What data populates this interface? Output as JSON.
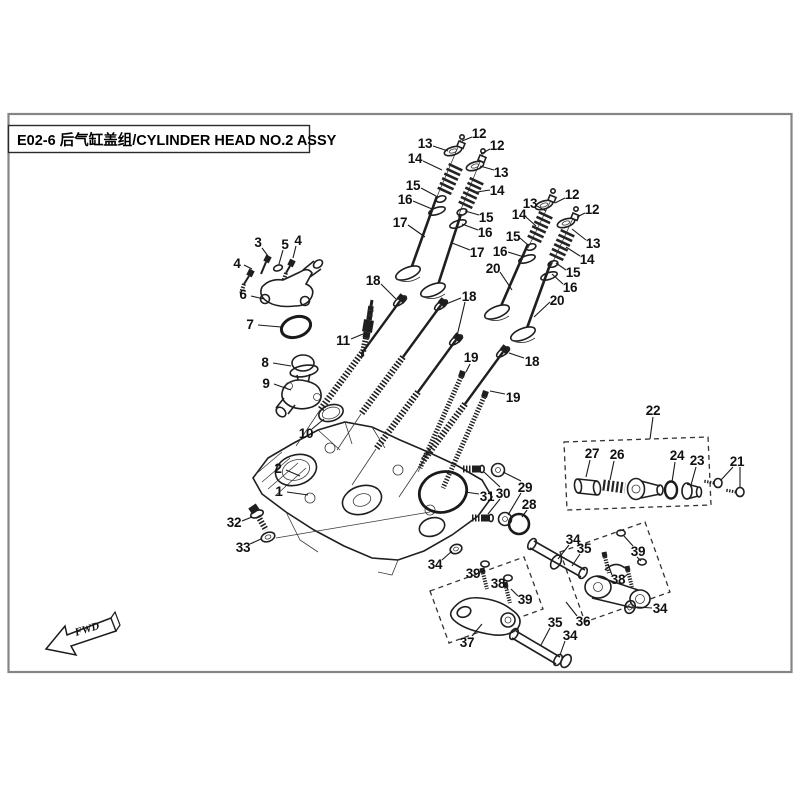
{
  "page": {
    "title": "E02-6 后气缸盖组/CYLINDER HEAD NO.2 ASSY",
    "fwd_label": "FWD"
  },
  "colors": {
    "line": "#1a1a1a",
    "border": "#8a8a8a"
  },
  "callouts": [
    {
      "n": "12",
      "x": 479,
      "y": 133,
      "l": [
        [
          472,
          137,
          462,
          141
        ]
      ]
    },
    {
      "n": "13",
      "x": 425,
      "y": 143,
      "l": [
        [
          433,
          146,
          448,
          151
        ]
      ]
    },
    {
      "n": "12",
      "x": 497,
      "y": 145,
      "l": [
        [
          490,
          149,
          481,
          154
        ]
      ]
    },
    {
      "n": "14",
      "x": 415,
      "y": 158,
      "l": [
        [
          423,
          161,
          442,
          170
        ]
      ]
    },
    {
      "n": "13",
      "x": 501,
      "y": 172,
      "l": [
        [
          494,
          170,
          480,
          166
        ]
      ]
    },
    {
      "n": "14",
      "x": 497,
      "y": 190,
      "l": [
        [
          490,
          190,
          477,
          192
        ]
      ]
    },
    {
      "n": "15",
      "x": 413,
      "y": 185,
      "l": [
        [
          421,
          188,
          436,
          196
        ]
      ]
    },
    {
      "n": "16",
      "x": 405,
      "y": 199,
      "l": [
        [
          413,
          201,
          432,
          209
        ]
      ]
    },
    {
      "n": "15",
      "x": 486,
      "y": 217,
      "l": [
        [
          479,
          215,
          465,
          211
        ]
      ]
    },
    {
      "n": "16",
      "x": 485,
      "y": 232,
      "l": [
        [
          478,
          230,
          462,
          224
        ]
      ]
    },
    {
      "n": "17",
      "x": 400,
      "y": 222,
      "l": [
        [
          408,
          225,
          425,
          237
        ]
      ]
    },
    {
      "n": "17",
      "x": 477,
      "y": 252,
      "l": [
        [
          470,
          250,
          452,
          243
        ]
      ]
    },
    {
      "n": "12",
      "x": 572,
      "y": 194,
      "l": [
        [
          565,
          198,
          555,
          203
        ]
      ]
    },
    {
      "n": "13",
      "x": 530,
      "y": 203,
      "l": [
        [
          537,
          206,
          546,
          211
        ]
      ]
    },
    {
      "n": "12",
      "x": 592,
      "y": 209,
      "l": [
        [
          585,
          213,
          577,
          217
        ]
      ]
    },
    {
      "n": "14",
      "x": 519,
      "y": 214,
      "l": [
        [
          526,
          217,
          536,
          226
        ]
      ]
    },
    {
      "n": "13",
      "x": 593,
      "y": 243,
      "l": [
        [
          586,
          240,
          572,
          229
        ]
      ]
    },
    {
      "n": "14",
      "x": 587,
      "y": 259,
      "l": [
        [
          580,
          256,
          566,
          247
        ]
      ]
    },
    {
      "n": "15",
      "x": 513,
      "y": 236,
      "l": [
        [
          520,
          238,
          528,
          245
        ]
      ]
    },
    {
      "n": "16",
      "x": 500,
      "y": 251,
      "l": [
        [
          508,
          252,
          524,
          257
        ]
      ]
    },
    {
      "n": "15",
      "x": 573,
      "y": 272,
      "l": [
        [
          566,
          270,
          556,
          263
        ]
      ]
    },
    {
      "n": "16",
      "x": 570,
      "y": 287,
      "l": [
        [
          563,
          284,
          552,
          274
        ]
      ]
    },
    {
      "n": "20",
      "x": 493,
      "y": 268,
      "l": [
        [
          500,
          272,
          512,
          290
        ]
      ]
    },
    {
      "n": "20",
      "x": 557,
      "y": 300,
      "l": [
        [
          550,
          302,
          534,
          317
        ]
      ]
    },
    {
      "n": "18",
      "x": 373,
      "y": 280,
      "l": [
        [
          381,
          284,
          396,
          299
        ]
      ]
    },
    {
      "n": "18",
      "x": 469,
      "y": 296,
      "l": [
        [
          461,
          298,
          446,
          304
        ],
        [
          465,
          302,
          457,
          336
        ]
      ]
    },
    {
      "n": "11",
      "x": 343,
      "y": 340,
      "l": [
        [
          351,
          339,
          363,
          334
        ]
      ]
    },
    {
      "n": "18",
      "x": 532,
      "y": 361,
      "l": [
        [
          524,
          358,
          509,
          353
        ]
      ]
    },
    {
      "n": "19",
      "x": 471,
      "y": 357,
      "l": [
        [
          470,
          364,
          466,
          372
        ]
      ]
    },
    {
      "n": "19",
      "x": 513,
      "y": 397,
      "l": [
        [
          505,
          394,
          490,
          391
        ]
      ]
    },
    {
      "n": "3",
      "x": 258,
      "y": 242,
      "l": [
        [
          262,
          248,
          268,
          256
        ]
      ]
    },
    {
      "n": "4",
      "x": 237,
      "y": 263,
      "l": [
        [
          244,
          265,
          252,
          269
        ]
      ]
    },
    {
      "n": "5",
      "x": 285,
      "y": 244,
      "l": [
        [
          283,
          250,
          279,
          264
        ]
      ]
    },
    {
      "n": "4",
      "x": 298,
      "y": 240,
      "l": [
        [
          296,
          246,
          293,
          258
        ]
      ]
    },
    {
      "n": "6",
      "x": 243,
      "y": 294,
      "l": [
        [
          251,
          296,
          264,
          299
        ]
      ]
    },
    {
      "n": "7",
      "x": 250,
      "y": 324,
      "l": [
        [
          258,
          325,
          281,
          327
        ]
      ]
    },
    {
      "n": "8",
      "x": 265,
      "y": 362,
      "l": [
        [
          273,
          363,
          291,
          366
        ]
      ]
    },
    {
      "n": "9",
      "x": 266,
      "y": 383,
      "l": [
        [
          274,
          384,
          291,
          390
        ]
      ]
    },
    {
      "n": "10",
      "x": 306,
      "y": 433,
      "l": [
        [
          312,
          429,
          324,
          419
        ]
      ]
    },
    {
      "n": "2",
      "x": 278,
      "y": 468,
      "l": [
        [
          286,
          470,
          300,
          476
        ]
      ]
    },
    {
      "n": "1",
      "x": 279,
      "y": 491,
      "l": [
        [
          287,
          492,
          308,
          495
        ]
      ]
    },
    {
      "n": "32",
      "x": 234,
      "y": 522,
      "l": [
        [
          242,
          521,
          252,
          517
        ]
      ]
    },
    {
      "n": "33",
      "x": 243,
      "y": 547,
      "l": [
        [
          250,
          544,
          261,
          539
        ]
      ]
    },
    {
      "n": "31",
      "x": 487,
      "y": 496,
      "l": [
        [
          479,
          494,
          465,
          492
        ]
      ]
    },
    {
      "n": "30",
      "x": 503,
      "y": 493,
      "l": [
        [
          500,
          487,
          484,
          472
        ],
        [
          500,
          499,
          488,
          514
        ]
      ]
    },
    {
      "n": "29",
      "x": 525,
      "y": 487,
      "l": [
        [
          521,
          481,
          503,
          472
        ],
        [
          521,
          493,
          508,
          515
        ]
      ]
    },
    {
      "n": "28",
      "x": 529,
      "y": 504,
      "l": [
        [
          527,
          510,
          522,
          517
        ]
      ]
    },
    {
      "n": "22",
      "x": 653,
      "y": 410,
      "l": [
        [
          653,
          417,
          650,
          439
        ]
      ]
    },
    {
      "n": "27",
      "x": 592,
      "y": 453,
      "l": [
        [
          590,
          460,
          586,
          477
        ]
      ]
    },
    {
      "n": "26",
      "x": 617,
      "y": 454,
      "l": [
        [
          614,
          461,
          610,
          480
        ]
      ]
    },
    {
      "n": "24",
      "x": 677,
      "y": 455,
      "l": [
        [
          675,
          462,
          672,
          482
        ]
      ]
    },
    {
      "n": "23",
      "x": 697,
      "y": 460,
      "l": [
        [
          696,
          467,
          691,
          485
        ]
      ]
    },
    {
      "n": "21",
      "x": 737,
      "y": 461,
      "l": [
        [
          733,
          467,
          721,
          480
        ],
        [
          740,
          467,
          740,
          487
        ]
      ]
    },
    {
      "n": "34",
      "x": 435,
      "y": 564,
      "l": [
        [
          442,
          560,
          452,
          551
        ]
      ]
    },
    {
      "n": "39",
      "x": 473,
      "y": 573,
      "l": [
        [
          480,
          572,
          484,
          570
        ]
      ]
    },
    {
      "n": "38",
      "x": 498,
      "y": 583,
      "l": [
        [
          504,
          585,
          508,
          589
        ]
      ]
    },
    {
      "n": "39",
      "x": 525,
      "y": 599,
      "l": [
        [
          518,
          596,
          511,
          589
        ]
      ]
    },
    {
      "n": "37",
      "x": 467,
      "y": 642,
      "l": [
        [
          472,
          636,
          482,
          624
        ]
      ]
    },
    {
      "n": "35",
      "x": 555,
      "y": 622,
      "l": [
        [
          550,
          628,
          541,
          645
        ]
      ]
    },
    {
      "n": "34",
      "x": 570,
      "y": 635,
      "l": [
        [
          565,
          641,
          560,
          655
        ]
      ]
    },
    {
      "n": "34",
      "x": 573,
      "y": 539,
      "l": [
        [
          569,
          545,
          558,
          559
        ]
      ]
    },
    {
      "n": "35",
      "x": 584,
      "y": 548,
      "l": [
        [
          580,
          554,
          572,
          566
        ]
      ]
    },
    {
      "n": "39",
      "x": 638,
      "y": 551,
      "l": [
        [
          633,
          546,
          624,
          536
        ],
        [
          637,
          557,
          641,
          561
        ]
      ]
    },
    {
      "n": "38",
      "x": 618,
      "y": 579,
      "l": [
        [
          612,
          575,
          608,
          564
        ],
        [
          623,
          578,
          628,
          574
        ]
      ]
    },
    {
      "n": "34",
      "x": 660,
      "y": 608,
      "l": [
        [
          652,
          608,
          637,
          607
        ]
      ]
    },
    {
      "n": "36",
      "x": 583,
      "y": 621,
      "l": [
        [
          577,
          616,
          566,
          602
        ]
      ]
    }
  ]
}
